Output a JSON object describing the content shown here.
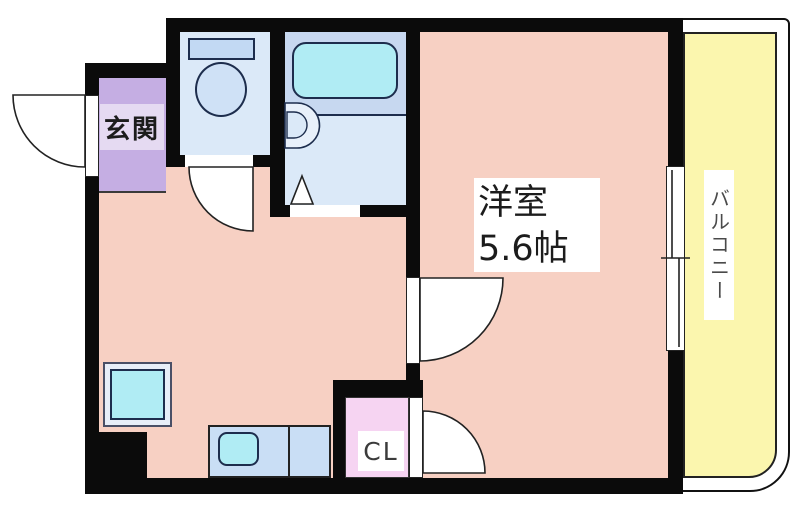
{
  "plan": {
    "type": "floor_plan",
    "labels": {
      "entrance": "玄関",
      "room_name": "洋室",
      "room_size": "5.6帖",
      "closet": "CL",
      "balcony": "バルコニー"
    },
    "rooms": [
      {
        "id": "entrance",
        "label": "玄関"
      },
      {
        "id": "western-room",
        "label": "洋室 5.6帖"
      },
      {
        "id": "closet",
        "label": "CL"
      },
      {
        "id": "balcony",
        "label": "バルコニー"
      },
      {
        "id": "kitchen-hall",
        "label": ""
      },
      {
        "id": "toilet-room",
        "label": ""
      },
      {
        "id": "bathroom",
        "label": ""
      }
    ],
    "fixtures": [
      "toilet-icon",
      "toilet-tank-icon",
      "bathtub-icon",
      "washbasin-icon",
      "bathroom-folding-door-icon",
      "washing-machine-pan-icon",
      "kitchen-counter-icon",
      "kitchen-sink-icon",
      "entrance-door-swing-icon",
      "toilet-door-swing-icon",
      "room-door-swing-icon",
      "closet-door-swing-icon",
      "sliding-window-icon"
    ]
  },
  "colors": {
    "wall": "#0b0b0b",
    "floor": "#f7d0c3",
    "entrance": "#c5aee3",
    "water": "#dbe9f8",
    "tub_area": "#c7d8f0",
    "cyan": "#b0ecf4",
    "counter": "#c9def5",
    "balcony": "#fbf6ae",
    "closet": "#f6d4f2",
    "ink": "#1c1c1c"
  }
}
